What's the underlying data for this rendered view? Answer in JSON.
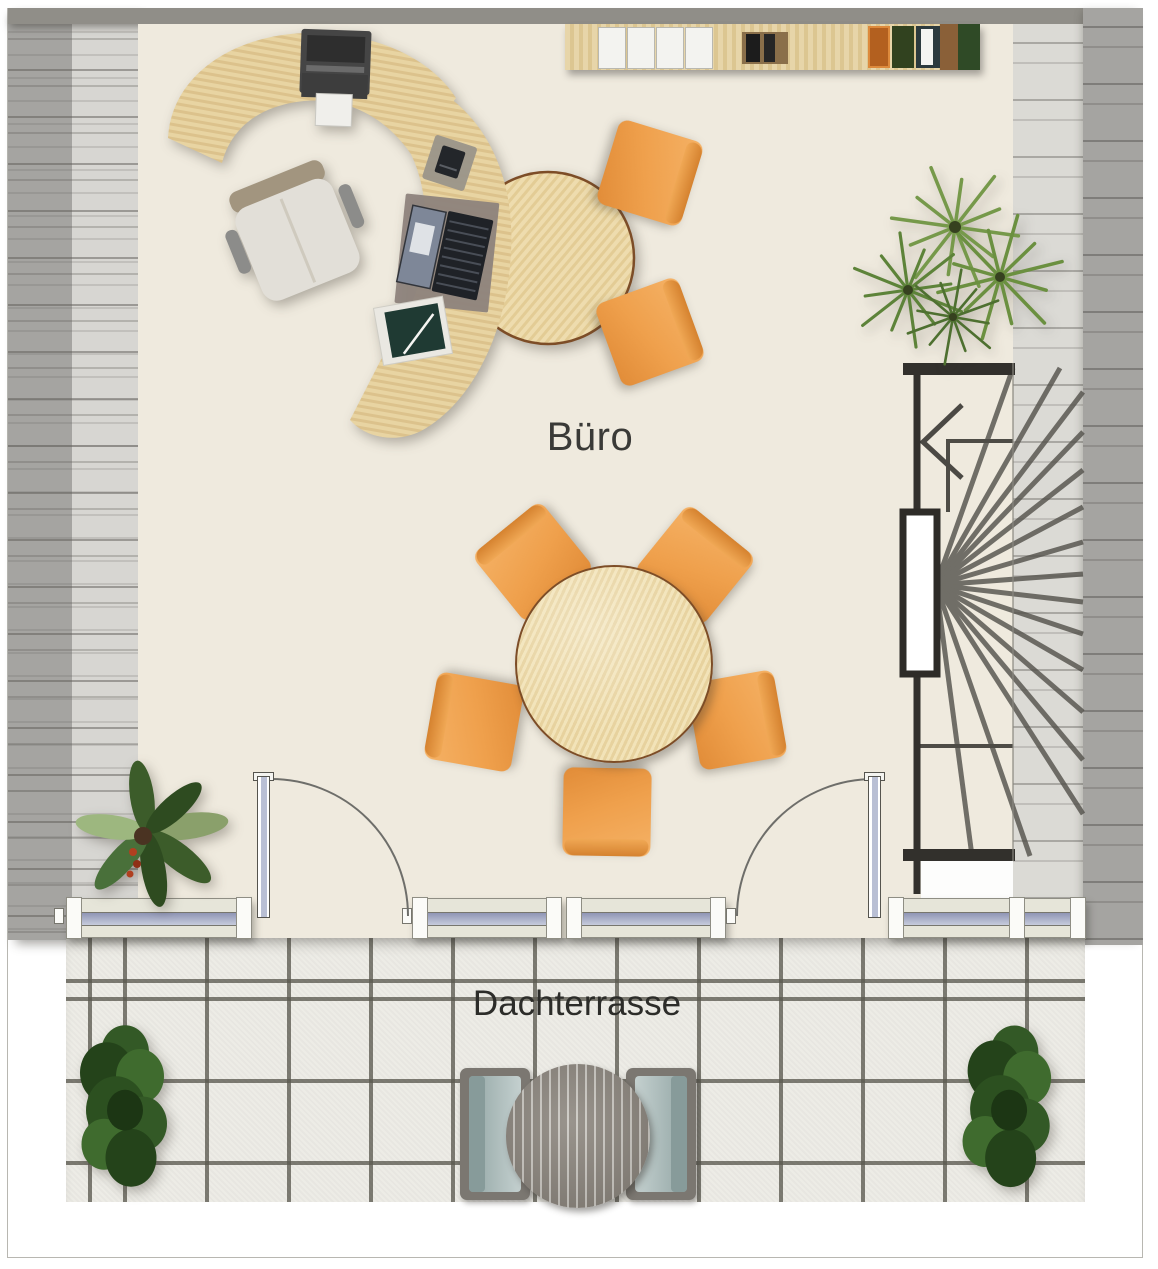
{
  "labels": {
    "office": "Büro",
    "terrace": "Dachterrasse"
  },
  "rooms": [
    {
      "name": "Büro",
      "type": "office"
    },
    {
      "name": "Dachterrasse",
      "type": "roof-terrace"
    }
  ],
  "palette": {
    "office_floor": "#efeade",
    "terrace_tile": "#edece6",
    "tile_grout": "#63625a",
    "wall_gray": "#908e88",
    "roof_hatch_dark": "#a5a4a1",
    "roof_hatch_light": "#d7d6d2",
    "desk_wood": "#e8d5a5",
    "wood_rim": "#7d4d27",
    "chair_orange": "#efa04c",
    "chair_orange_dark": "#d5822f",
    "window_glass": "#a9afc8",
    "window_frame": "#e6e5d9",
    "stair_line": "#4e4c46",
    "stair_wall": "#32302c",
    "terrace_furniture": "#8b857d",
    "cushion_blue": "#b7c4c3",
    "plant_green": "#4e7a33"
  },
  "furniture": {
    "office": [
      "curved-desk-return",
      "curved-desk-main",
      "round-desk-extension",
      "printer",
      "office-swivel-chair",
      "laptop",
      "desk-pad",
      "phone-pda",
      "notebook-with-pen",
      "guest-chair",
      "guest-chair",
      "meeting-table-round",
      "meeting-chair-x5",
      "sideboard-shelf",
      "palm-plant",
      "leaf-plant",
      "winder-staircase"
    ],
    "terrace": [
      "round-slatted-table",
      "lounge-chair",
      "lounge-chair",
      "bush-plant",
      "bush-plant"
    ]
  }
}
